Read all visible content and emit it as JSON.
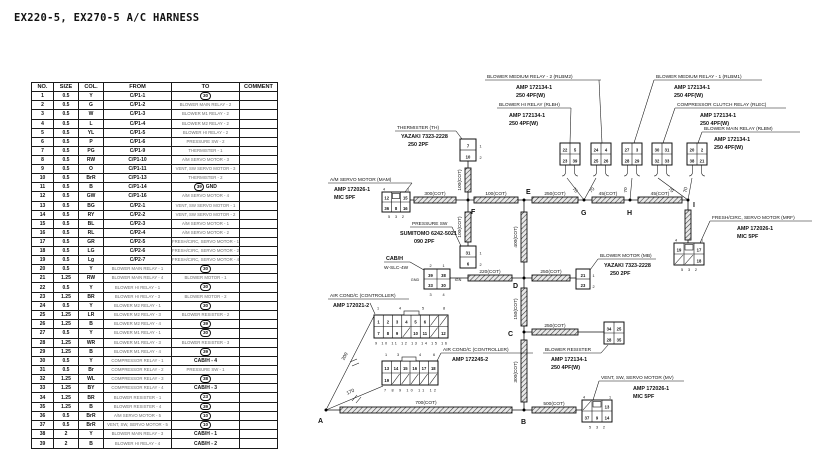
{
  "title": "EX220-5, EX270-5  A/C HARNESS",
  "table": {
    "headers": [
      "NO.",
      "SIZE",
      "COL.",
      "FROM",
      "TO",
      "COMMENT"
    ],
    "rows": [
      [
        "1",
        "0.5",
        "Y",
        "C/P1-1",
        "(30)",
        ""
      ],
      [
        "2",
        "0.5",
        "G",
        "C/P1-2",
        "BLOWER MAIN RELAY - 2",
        ""
      ],
      [
        "3",
        "0.5",
        "W",
        "C/P1-3",
        "BLOWER M1 RELAY - 2",
        ""
      ],
      [
        "4",
        "0.5",
        "L",
        "C/P1-4",
        "BLOWER M2 RELAY - 2",
        ""
      ],
      [
        "5",
        "0.5",
        "YL",
        "C/P1-5",
        "BLOWER HI RELAY - 2",
        ""
      ],
      [
        "6",
        "0.5",
        "P",
        "C/P1-6",
        "PRESSURE SW - 2",
        ""
      ],
      [
        "7",
        "0.5",
        "PG",
        "C/P1-9",
        "THERMISTER - 1",
        ""
      ],
      [
        "8",
        "0.5",
        "RW",
        "C/P1-10",
        "A/M SERVO MOTOR - 3",
        ""
      ],
      [
        "9",
        "0.5",
        "O",
        "C/P1-11",
        "VENT, SW SERVO MOTOR - 3",
        ""
      ],
      [
        "10",
        "0.5",
        "BrR",
        "C/P1-13",
        "THERMISTER - 2",
        ""
      ],
      [
        "11",
        "0.5",
        "B",
        "C/P1-14",
        "(39) GND",
        ""
      ],
      [
        "12",
        "0.5",
        "GW",
        "C/P1-16",
        "A/M SERVO MOTOR - 4",
        ""
      ],
      [
        "13",
        "0.5",
        "BG",
        "C/P2-1",
        "VENT, SW SERVO MOTOR - 1",
        ""
      ],
      [
        "14",
        "0.5",
        "RY",
        "C/P2-2",
        "VENT, SW SERVO MOTOR - 2",
        ""
      ],
      [
        "15",
        "0.5",
        "BL",
        "C/P2-3",
        "A/M SERVO MOTOR - 1",
        ""
      ],
      [
        "16",
        "0.5",
        "RL",
        "C/P2-4",
        "A/M SERVO MOTOR - 2",
        ""
      ],
      [
        "17",
        "0.5",
        "GR",
        "C/P2-5",
        "FRESH/CIRC, SERVO MOTOR - 1",
        ""
      ],
      [
        "18",
        "0.5",
        "LG",
        "C/P2-6",
        "FRESH/CIRC, SERVO MOTOR - 2",
        ""
      ],
      [
        "19",
        "0.5",
        "Lg",
        "C/P2-7",
        "FRESH/CIRC, SERVO MOTOR - 4",
        ""
      ],
      [
        "20",
        "0.5",
        "Y",
        "BLOWER MAIN RELAY - 1",
        "(30)",
        ""
      ],
      [
        "21",
        "1.25",
        "RW",
        "BLOWER MAIN RELAY - 4",
        "BLOWER MOTOR - 1",
        ""
      ],
      [
        "22",
        "0.5",
        "Y",
        "BLOWER HI RELAY - 1",
        "(30)",
        ""
      ],
      [
        "23",
        "1.25",
        "BR",
        "BLOWER HI RELAY - 3",
        "BLOWER MOTOR - 2",
        ""
      ],
      [
        "24",
        "0.5",
        "Y",
        "BLOWER M2 RELAY - 1",
        "(30)",
        ""
      ],
      [
        "25",
        "1.25",
        "LR",
        "BLOWER M2 RELAY - 3",
        "BLOWER RESISTER - 2",
        ""
      ],
      [
        "26",
        "1.25",
        "B",
        "BLOWER M2 RELAY - 4",
        "(39)",
        ""
      ],
      [
        "27",
        "0.5",
        "Y",
        "BLOWER M1 RELAY - 1",
        "(30)",
        ""
      ],
      [
        "28",
        "1.25",
        "WR",
        "BLOWER M1 RELAY - 3",
        "BLOWER RESISTER - 3",
        ""
      ],
      [
        "29",
        "1.25",
        "B",
        "BLOWER M1 RELAY - 4",
        "(39)",
        ""
      ],
      [
        "30",
        "0.5",
        "Y",
        "COMPRESSOR RELAY - 1",
        "CAB/H - 4",
        ""
      ],
      [
        "31",
        "0.5",
        "Br",
        "COMPRESSOR RELAY - 2",
        "PRESSURE SW - 1",
        ""
      ],
      [
        "32",
        "1.25",
        "WL",
        "COMPRESSOR RELAY - 3",
        "(38)",
        ""
      ],
      [
        "33",
        "1.25",
        "BY",
        "COMPRESSOR RELAY - 4",
        "CAB/H - 3",
        ""
      ],
      [
        "34",
        "1.25",
        "BR",
        "BLOWER RESISTER - 1",
        "(23)",
        ""
      ],
      [
        "35",
        "1.25",
        "B",
        "BLOWER RESISTER - 4",
        "(39)",
        ""
      ],
      [
        "36",
        "0.5",
        "BrR",
        "A/M SERVO MOTOR - 5",
        "(10)",
        ""
      ],
      [
        "37",
        "0.5",
        "BrR",
        "VENT, SW, SERVO MOTOR - 5",
        "(10)",
        ""
      ],
      [
        "38",
        "2",
        "Y",
        "BLOWER MAIN RELAY - 3",
        "CAB/H - 1",
        ""
      ],
      [
        "39",
        "2",
        "B",
        "BLOWER HI RELAY - 4",
        "CAB/H - 2",
        ""
      ]
    ]
  },
  "diagram": {
    "nodes": {
      "a": "A",
      "b": "B",
      "c": "C",
      "d": "D",
      "e": "E",
      "f": "F",
      "g": "G",
      "h": "H",
      "i": "I"
    },
    "tubes": {
      "t700": "700(COT)",
      "t500": "500(COT)",
      "t300": "300(COT)",
      "t100": "100(COT)",
      "t250": "250(COT)",
      "t45": "45(COT)",
      "t400": "400(COT)",
      "t220": "220(COT)",
      "t150": "150(COT)",
      "t70": "70",
      "t200": "200",
      "t170": "170"
    },
    "misc": {
      "gnd": "GND",
      "ign": "IGN"
    },
    "devices": {
      "th": {
        "n": "THERMISTER (TH)",
        "p": "YAZAKI 7323-2228",
        "s": "250 2PF"
      },
      "psw": {
        "n": "PRESSURE SW",
        "p": "SUMITOMO 6242-5021",
        "s": "090 2PF"
      },
      "mam": {
        "n": "A/M SERVO MOTOR (MAM)",
        "p": "AMP 172026-1",
        "s": "MIC 5PF"
      },
      "cabh": {
        "n": "CAB/H",
        "p": "W-SLC-4W"
      },
      "cp1": {
        "n": "AIR COND/C (CONTROLLER)",
        "p": "AMP 172021-2"
      },
      "cp2": {
        "n": "AIR COND/C (CONTROLLER)",
        "p": "AMP 172245-2"
      },
      "rlbm2": {
        "n": "BLOWER MEDIUM RELAY - 2 (RLBM2)",
        "p": "AMP 172134-1",
        "s": "250 4PF(W)"
      },
      "rlbh": {
        "n": "BLOWER HI RELAY (RLBH)",
        "p": "AMP 172134-1",
        "s": "250 4PF(W)"
      },
      "rlbm1": {
        "n": "BLOWER MEDIUM RELAY - 1 (RLBM1)",
        "p": "AMP 172134-1",
        "s": "250 4PF(W)"
      },
      "rlec": {
        "n": "COMPRESSOR CLUTCH RELAY (RLEC)",
        "p": "AMP 172134-1",
        "s": "250 4PF(W)"
      },
      "rlbm": {
        "n": "BLOWER MAIN RELAY (RLBM)",
        "p": "AMP 172134-1",
        "s": "250 4PF(W)"
      },
      "mb": {
        "n": "BLOWER MOTOR (MB)",
        "p": "YAZAKI 7323-2228",
        "s": "250 2PF"
      },
      "mrf": {
        "n": "FRESH/CIRC, SERVO MOTOR (MRF)",
        "p": "AMP 172026-1",
        "s": "MIC 5PF"
      },
      "res": {
        "n": "BLOWER RESISTER",
        "p": "AMP 172134-1",
        "s": "250 4PF(W)"
      },
      "mv": {
        "n": "VENT, SW, SERVO MOTOR (MV)",
        "p": "AMP 172026-1",
        "s": "MIC 5PF"
      }
    },
    "conn": {
      "th": {
        "c": [
          "7",
          "10"
        ],
        "p": [
          "1",
          "2"
        ]
      },
      "psw": {
        "c": [
          "31",
          "6"
        ],
        "p": [
          "1",
          "2"
        ]
      },
      "mb": {
        "c": [
          "21",
          "23"
        ],
        "p": [
          "1",
          "2"
        ]
      },
      "cabh": {
        "r1": [
          "39",
          "38"
        ],
        "r2": [
          "33",
          "30"
        ],
        "pt": [
          "2",
          "1"
        ],
        "pb": [
          "3",
          "4"
        ]
      },
      "mam": {
        "r1": [
          "12",
          "15"
        ],
        "r2": [
          "36",
          "8",
          "16"
        ],
        "pt": [
          "4",
          "1"
        ],
        "pb": "5 3 2"
      },
      "mv": {
        "r1": [
          "13"
        ],
        "r2": [
          "37",
          "9",
          "14"
        ],
        "pt": [
          "4",
          "1"
        ],
        "pb": "5 3 2"
      },
      "mrf": {
        "r1": [
          "19",
          "17"
        ],
        "r2": [
          "18"
        ],
        "pt": [
          "4",
          "1"
        ],
        "pb": "5 3 2"
      },
      "cp1": {
        "r1": [
          "1",
          "2",
          "3",
          "4",
          "5",
          "6"
        ],
        "r2": [
          "7",
          "8",
          "9",
          "10",
          "11",
          "12"
        ],
        "pt": [
          "1",
          "4",
          "5",
          "8"
        ],
        "pb": "9 10 11 12 13 14 15 16"
      },
      "cp2": {
        "r1": [
          "13",
          "14",
          "15",
          "16",
          "17",
          "18"
        ],
        "r2": [
          "19"
        ],
        "pt": [
          "1",
          "3",
          "4",
          "6"
        ],
        "pb": "7 8 9 10 11 12"
      },
      "res": {
        "r1": [
          "34",
          "25"
        ],
        "r2": [
          "28",
          "35"
        ]
      },
      "rlbh": {
        "r1": [
          "22",
          "5"
        ],
        "r2": [
          "23",
          "39"
        ]
      },
      "rlbm2": {
        "r1": [
          "24",
          "4"
        ],
        "r2": [
          "25",
          "26"
        ]
      },
      "rlbm1": {
        "r1": [
          "27",
          "3"
        ],
        "r2": [
          "28",
          "29"
        ]
      },
      "rlec": {
        "r1": [
          "30",
          "31"
        ],
        "r2": [
          "32",
          "33"
        ]
      },
      "rlbm": {
        "r1": [
          "20",
          "2"
        ],
        "r2": [
          "38",
          "21"
        ]
      }
    }
  }
}
